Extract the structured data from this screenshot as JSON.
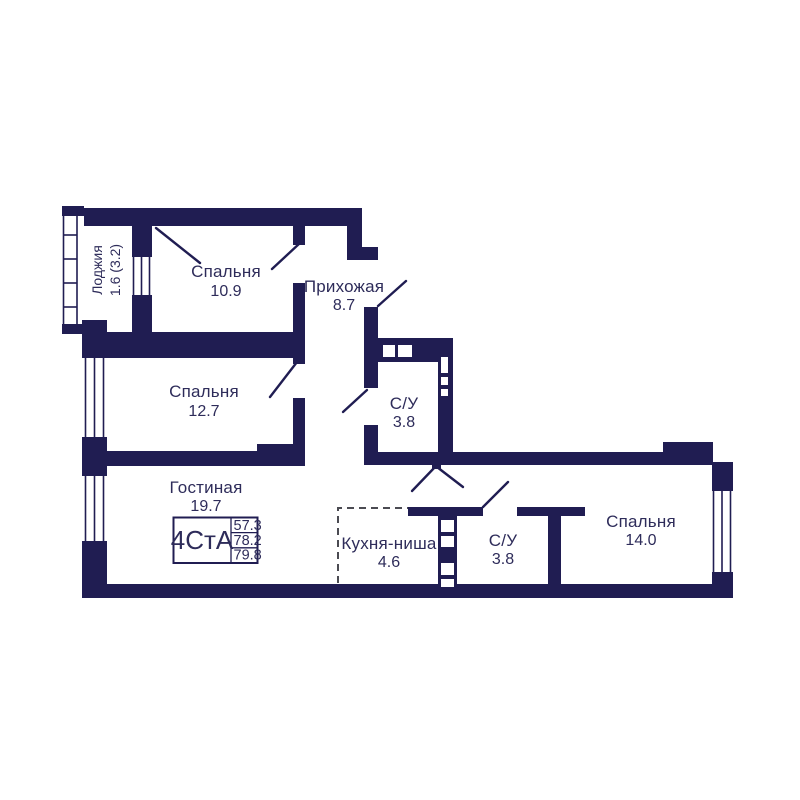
{
  "plan": {
    "unit_label": "4СтА",
    "area_values": [
      "57.3",
      "78.2",
      "79.8"
    ],
    "rooms": [
      {
        "name": "Лоджия",
        "area": "1.6 (3.2)"
      },
      {
        "name": "Спальня",
        "area": "10.9"
      },
      {
        "name": "Прихожая",
        "area": "8.7"
      },
      {
        "name": "Спальня",
        "area": "12.7"
      },
      {
        "name": "С/У",
        "area": "3.8"
      },
      {
        "name": "Гостиная",
        "area": "19.7"
      },
      {
        "name": "Кухня-ниша",
        "area": "4.6"
      },
      {
        "name": "С/У",
        "area": "3.8"
      },
      {
        "name": "Спальня",
        "area": "14.0"
      }
    ],
    "colors": {
      "wall": "#201d52",
      "text": "#2e2c5a",
      "dashed_line": "#4b4b52",
      "background": "#ffffff"
    }
  }
}
